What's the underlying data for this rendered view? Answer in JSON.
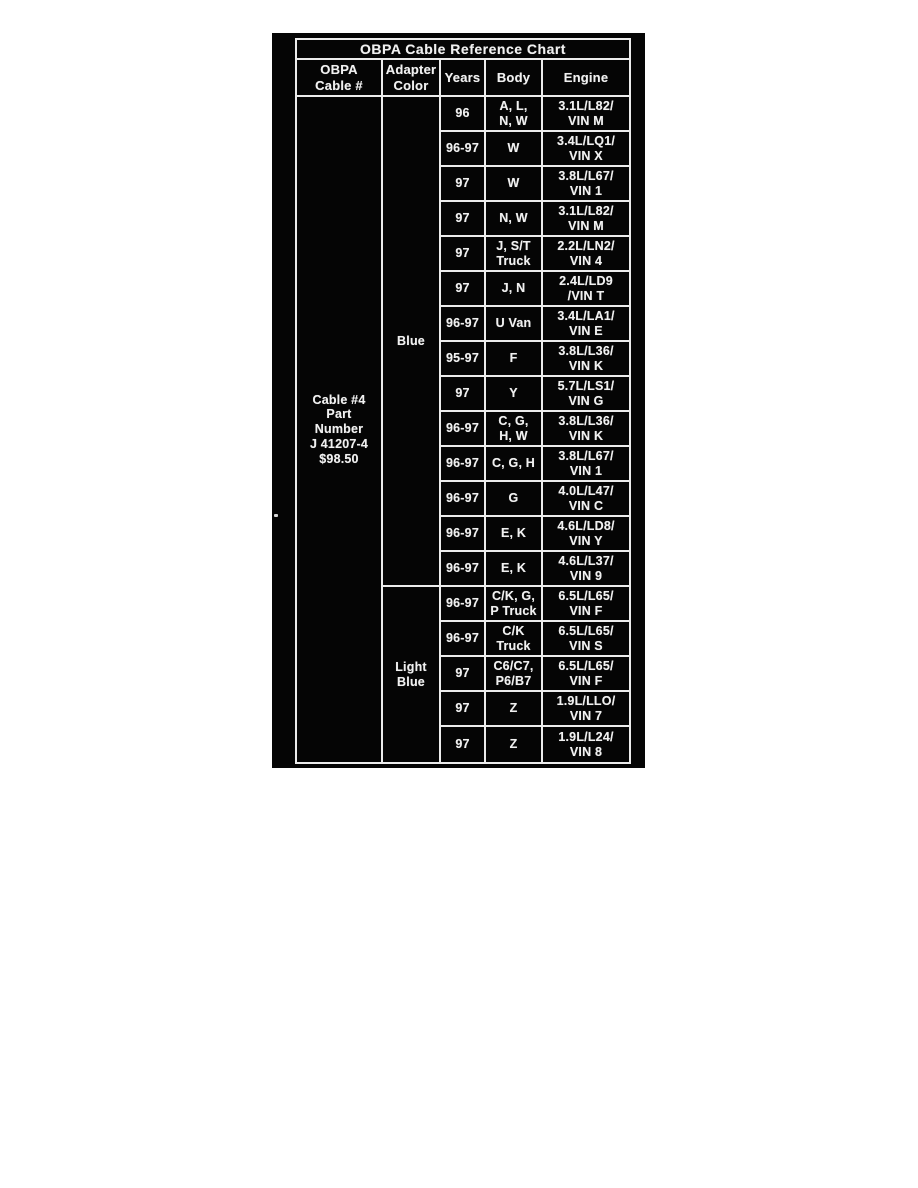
{
  "document": {
    "title": "OBPA Cable Reference Chart",
    "headers": [
      "OBPA\nCable #",
      "Adapter\nColor",
      "Years",
      "Body",
      "Engine"
    ],
    "cable_info": "Cable #4\nPart\nNumber\nJ 41207-4\n$98.50",
    "adapter_colors": [
      {
        "label": "Blue",
        "row_span": 14
      },
      {
        "label": "Light\nBlue",
        "row_span": 5
      }
    ],
    "rows": [
      {
        "years": "96",
        "body": "A, L,\nN, W",
        "engine": "3.1L/L82/\nVIN M"
      },
      {
        "years": "96-97",
        "body": "W",
        "engine": "3.4L/LQ1/\nVIN X"
      },
      {
        "years": "97",
        "body": "W",
        "engine": "3.8L/L67/\nVIN 1"
      },
      {
        "years": "97",
        "body": "N, W",
        "engine": "3.1L/L82/\nVIN M"
      },
      {
        "years": "97",
        "body": "J, S/T\nTruck",
        "engine": "2.2L/LN2/\nVIN 4"
      },
      {
        "years": "97",
        "body": "J, N",
        "engine": "2.4L/LD9\n/VIN T"
      },
      {
        "years": "96-97",
        "body": "U Van",
        "engine": "3.4L/LA1/\nVIN E"
      },
      {
        "years": "95-97",
        "body": "F",
        "engine": "3.8L/L36/\nVIN K"
      },
      {
        "years": "97",
        "body": "Y",
        "engine": "5.7L/LS1/\nVIN G"
      },
      {
        "years": "96-97",
        "body": "C, G,\nH, W",
        "engine": "3.8L/L36/\nVIN K"
      },
      {
        "years": "96-97",
        "body": "C, G, H",
        "engine": "3.8L/L67/\nVIN 1"
      },
      {
        "years": "96-97",
        "body": "G",
        "engine": "4.0L/L47/\nVIN C"
      },
      {
        "years": "96-97",
        "body": "E, K",
        "engine": "4.6L/LD8/\nVIN Y"
      },
      {
        "years": "96-97",
        "body": "E, K",
        "engine": "4.6L/L37/\nVIN 9"
      },
      {
        "years": "96-97",
        "body": "C/K, G,\nP Truck",
        "engine": "6.5L/L65/\nVIN F"
      },
      {
        "years": "96-97",
        "body": "C/K\nTruck",
        "engine": "6.5L/L65/\nVIN S"
      },
      {
        "years": "97",
        "body": "C6/C7,\nP6/B7",
        "engine": "6.5L/L65/\nVIN F"
      },
      {
        "years": "97",
        "body": "Z",
        "engine": "1.9L/LLO/\nVIN 7"
      },
      {
        "years": "97",
        "body": "Z",
        "engine": "1.9L/L24/\nVIN 8"
      }
    ],
    "colors": {
      "page_background": "#ffffff",
      "table_background": "#050505",
      "text": "#f0f0f0",
      "border": "#ececec"
    }
  }
}
